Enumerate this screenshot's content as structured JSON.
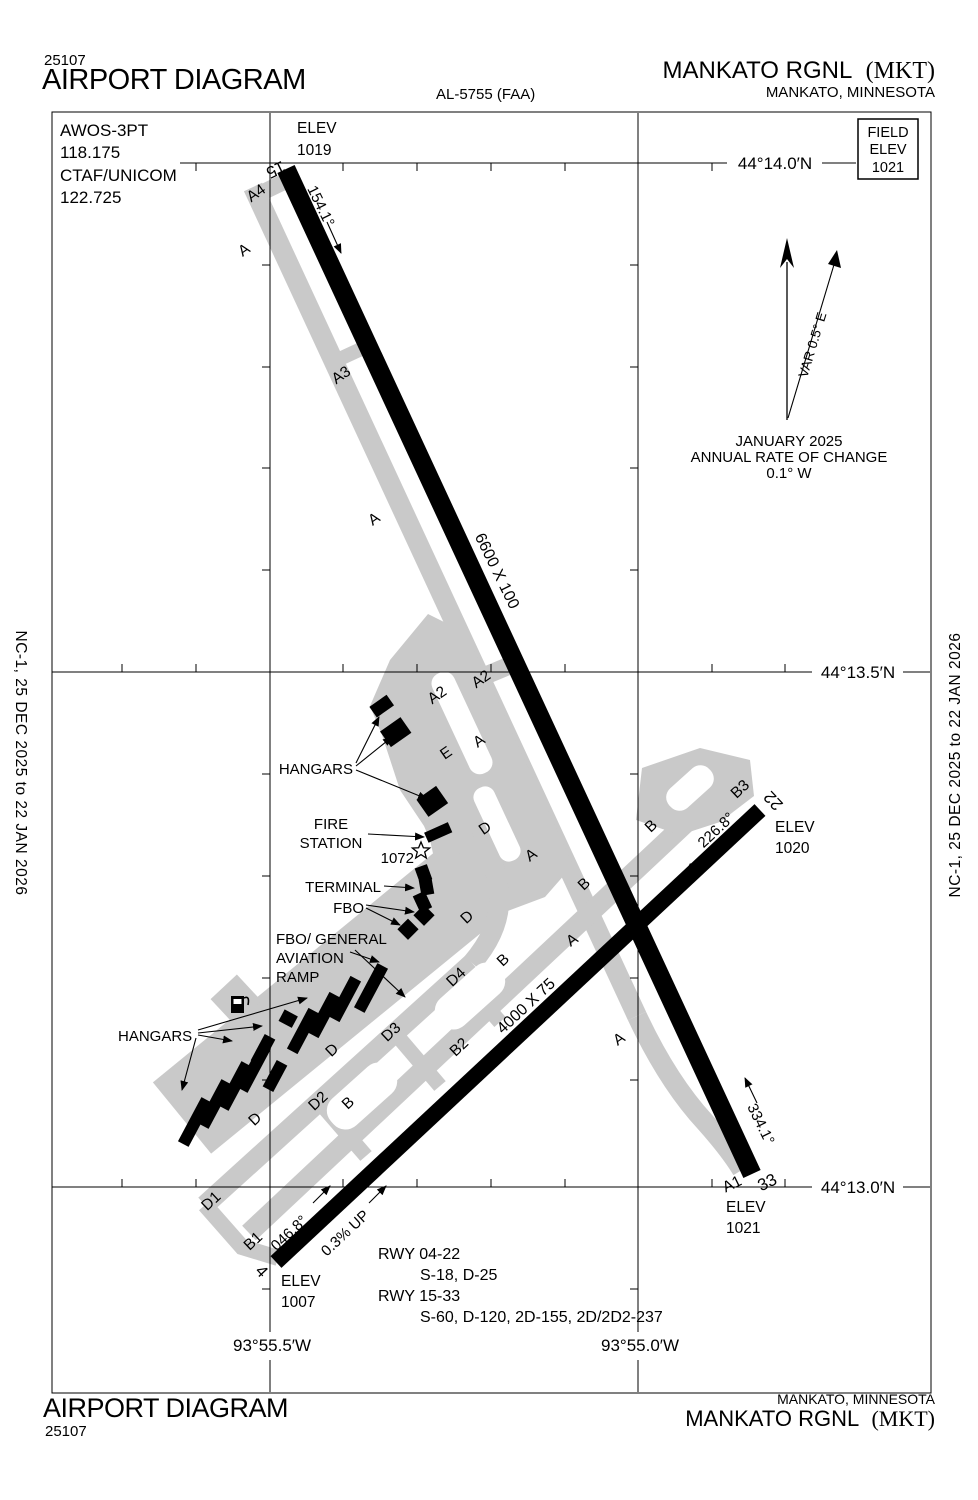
{
  "doc": {
    "chart_number": "25107",
    "title": "AIRPORT DIAGRAM",
    "procedure_id": "AL-5755 (FAA)",
    "airport_name": "MANKATO RGNL",
    "airport_id": "(MKT)",
    "city": "MANKATO, MINNESOTA",
    "edition": "NC-1,  25 DEC 2025  to  22 JAN 2026"
  },
  "comms": {
    "awos_label": "AWOS-3PT",
    "awos_freq": "118.175",
    "ctaf_label": "CTAF/UNICOM",
    "ctaf_freq": "122.725"
  },
  "field_elev": {
    "line1": "FIELD",
    "line2": "ELEV",
    "line3": "1021"
  },
  "graticule": {
    "lat_14_0": "44°14.0′N",
    "lat_13_5": "44°13.5′N",
    "lat_13_0": "44°13.0′N",
    "lon_55_5": "93°55.5′W",
    "lon_55_0": "93°55.0′W"
  },
  "compass": {
    "variation": "VAR 0.5° E",
    "date": "JANUARY 2025",
    "rate_label": "ANNUAL RATE OF CHANGE",
    "rate_value": "0.1° W"
  },
  "runway_15_33": {
    "end_15": "15",
    "end_33": "33",
    "heading_15": "154.1°",
    "heading_33": "334.1°",
    "dimensions": "6600 X 100"
  },
  "runway_04_22": {
    "end_04": "4",
    "end_22": "22",
    "heading_04": "046.8°",
    "heading_22": "226.8°",
    "dimensions": "4000 X 75",
    "gradient": "0.3% UP"
  },
  "elevations": {
    "label": "ELEV",
    "rwy15": "1019",
    "rwy22": "1020",
    "rwy33": "1021",
    "rwy04": "1007"
  },
  "taxiways": {
    "a": "A",
    "a1": "A1",
    "a2": "A2",
    "a3": "A3",
    "a4": "A4",
    "b": "B",
    "b1": "B1",
    "b2": "B2",
    "b3": "B3",
    "d": "D",
    "d1": "D1",
    "d2": "D2",
    "d3": "D3",
    "d4": "D4",
    "e": "E"
  },
  "features": {
    "hangars": "HANGARS",
    "fire_line1": "FIRE",
    "fire_line2": "STATION",
    "beacon_elev": "1072",
    "terminal": "TERMINAL",
    "fbo": "FBO",
    "ramp_line1": "FBO/ GENERAL",
    "ramp_line2": "AVIATION",
    "ramp_line3": "RAMP"
  },
  "runway_data": {
    "rwy1_label": "RWY 04-22",
    "rwy1_codes": "S-18, D-25",
    "rwy2_label": "RWY 15-33",
    "rwy2_codes": "S-60, D-120, 2D-155, 2D/2D2-237"
  }
}
